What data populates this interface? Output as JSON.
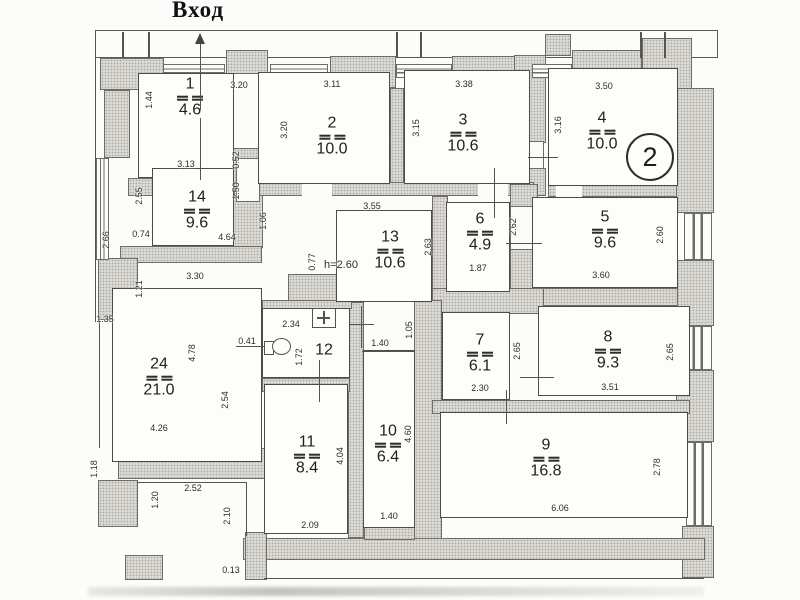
{
  "title": "Вход",
  "floor_badge": "2",
  "rooms": [
    {
      "key": "r1",
      "number": "1",
      "area": "4.6"
    },
    {
      "key": "r2",
      "number": "2",
      "area": "10.0"
    },
    {
      "key": "r3",
      "number": "3",
      "area": "10.6"
    },
    {
      "key": "r4",
      "number": "4",
      "area": "10.0"
    },
    {
      "key": "r14",
      "number": "14",
      "area": "9.6"
    },
    {
      "key": "r13",
      "number": "13",
      "area": "10.6"
    },
    {
      "key": "r6",
      "number": "6",
      "area": "4.9"
    },
    {
      "key": "r5",
      "number": "5",
      "area": "9.6"
    },
    {
      "key": "r24",
      "number": "24",
      "area": "21.0"
    },
    {
      "key": "r12",
      "number": "12",
      "area": ""
    },
    {
      "key": "r7",
      "number": "7",
      "area": "6.1"
    },
    {
      "key": "r8",
      "number": "8",
      "area": "9.3"
    },
    {
      "key": "r11",
      "number": "11",
      "area": "8.4"
    },
    {
      "key": "r10",
      "number": "10",
      "area": "6.4"
    },
    {
      "key": "r9",
      "number": "9",
      "area": "16.8"
    }
  ],
  "dimensions": [
    {
      "value": "1.44",
      "orientation": "vertical"
    },
    {
      "value": "3.20",
      "orientation": "horizontal"
    },
    {
      "value": "3.11",
      "orientation": "horizontal"
    },
    {
      "value": "3.20",
      "orientation": "vertical"
    },
    {
      "value": "3.38",
      "orientation": "horizontal"
    },
    {
      "value": "3.15",
      "orientation": "vertical"
    },
    {
      "value": "3.50",
      "orientation": "horizontal"
    },
    {
      "value": "3.16",
      "orientation": "vertical"
    },
    {
      "value": "3.13",
      "orientation": "horizontal"
    },
    {
      "value": "0.52",
      "orientation": "vertical"
    },
    {
      "value": "1.50",
      "orientation": "vertical"
    },
    {
      "value": "2.55",
      "orientation": "vertical"
    },
    {
      "value": "0.74",
      "orientation": "horizontal"
    },
    {
      "value": "4.64",
      "orientation": "horizontal"
    },
    {
      "value": "1.06",
      "orientation": "vertical"
    },
    {
      "value": "3.55",
      "orientation": "horizontal"
    },
    {
      "value": "2.63",
      "orientation": "vertical"
    },
    {
      "value": "2.62",
      "orientation": "vertical"
    },
    {
      "value": "1.87",
      "orientation": "horizontal"
    },
    {
      "value": "2.60",
      "orientation": "vertical"
    },
    {
      "value": "3.60",
      "orientation": "horizontal"
    },
    {
      "value": "0.77",
      "orientation": "vertical"
    },
    {
      "value": "h=2.60",
      "orientation": "horizontal"
    },
    {
      "value": "2.66",
      "orientation": "vertical"
    },
    {
      "value": "1.21",
      "orientation": "vertical"
    },
    {
      "value": "1.35",
      "orientation": "horizontal"
    },
    {
      "value": "3.30",
      "orientation": "horizontal"
    },
    {
      "value": "0.41",
      "orientation": "horizontal"
    },
    {
      "value": "4.78",
      "orientation": "vertical"
    },
    {
      "value": "2.54",
      "orientation": "vertical"
    },
    {
      "value": "4.26",
      "orientation": "horizontal"
    },
    {
      "value": "2.34",
      "orientation": "horizontal"
    },
    {
      "value": "1.72",
      "orientation": "vertical"
    },
    {
      "value": "1.40",
      "orientation": "horizontal"
    },
    {
      "value": "1.05",
      "orientation": "vertical"
    },
    {
      "value": "2.30",
      "orientation": "horizontal"
    },
    {
      "value": "2.65",
      "orientation": "vertical"
    },
    {
      "value": "3.51",
      "orientation": "horizontal"
    },
    {
      "value": "2.65",
      "orientation": "vertical"
    },
    {
      "value": "4.04",
      "orientation": "vertical"
    },
    {
      "value": "2.09",
      "orientation": "horizontal"
    },
    {
      "value": "4.60",
      "orientation": "vertical"
    },
    {
      "value": "1.40",
      "orientation": "horizontal"
    },
    {
      "value": "6.06",
      "orientation": "horizontal"
    },
    {
      "value": "2.78",
      "orientation": "vertical"
    },
    {
      "value": "1.18",
      "orientation": "vertical"
    },
    {
      "value": "1.20",
      "orientation": "vertical"
    },
    {
      "value": "2.52",
      "orientation": "horizontal"
    },
    {
      "value": "2.10",
      "orientation": "vertical"
    },
    {
      "value": "0.13",
      "orientation": "horizontal"
    }
  ]
}
